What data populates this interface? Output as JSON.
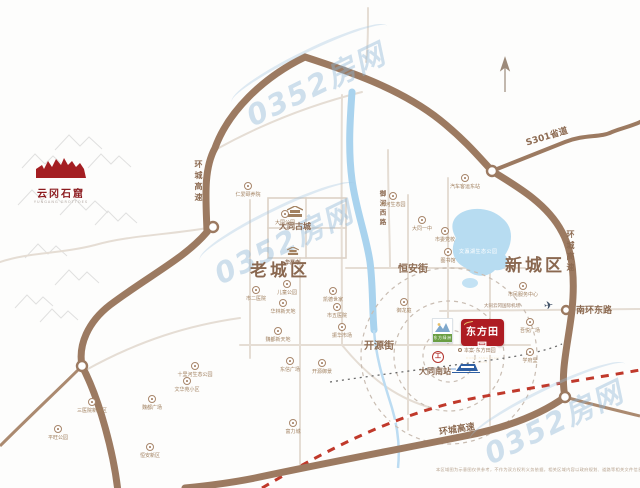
{
  "watermark": {
    "text": "0352房网"
  },
  "logos": {
    "yungang": {
      "title": "云冈石窟",
      "subtitle": "YUNGANG GROTTOES"
    },
    "project": {
      "name": "东方田园",
      "sub": "DONG FANG TIAN YUAN",
      "color": "#ae1c23"
    },
    "sister": {
      "name": "东方绿洲",
      "color": "#6a9e43"
    },
    "site_note": "本案·东方田园"
  },
  "districts": [
    {
      "text": "老城区",
      "x": 250,
      "y": 256
    },
    {
      "text": "新城区",
      "x": 505,
      "y": 251
    }
  ],
  "landmarks": [
    {
      "text": "大同古城"
    },
    {
      "text": "华严寺"
    }
  ],
  "station": {
    "text": "大同南站"
  },
  "lake": {
    "text": "文瀛湖生态公园"
  },
  "airport": {
    "text": "大同云冈国际机场"
  },
  "road_labels": [
    {
      "text": "环城高速",
      "x": 193,
      "y": 160,
      "vertical": true,
      "size": 8
    },
    {
      "text": "环城高速",
      "x": 565,
      "y": 230,
      "vertical": true,
      "size": 8
    },
    {
      "text": "御河西路",
      "x": 377,
      "y": 190,
      "vertical": true,
      "size": 6.5
    },
    {
      "text": "S301省道",
      "x": 524,
      "y": 136,
      "rot": -17,
      "size": 9
    },
    {
      "text": "南环东路",
      "x": 576,
      "y": 303,
      "size": 9
    },
    {
      "text": "恒安街",
      "x": 398,
      "y": 260,
      "size": 10
    },
    {
      "text": "开源街",
      "x": 364,
      "y": 337,
      "size": 10
    },
    {
      "text": "环城高速",
      "x": 438,
      "y": 425,
      "rot": -9,
      "size": 9
    }
  ],
  "markers": [
    {
      "x": 248,
      "y": 186,
      "label": "仁爱颐养院"
    },
    {
      "x": 285,
      "y": 214,
      "label": "大同公园"
    },
    {
      "x": 256,
      "y": 290,
      "label": "市二医院"
    },
    {
      "x": 287,
      "y": 284,
      "label": "儿童公园"
    },
    {
      "x": 283,
      "y": 303,
      "label": "华林新天地"
    },
    {
      "x": 333,
      "y": 291,
      "label": "凯德世家"
    },
    {
      "x": 337,
      "y": 307,
      "label": "市五医院"
    },
    {
      "x": 342,
      "y": 327,
      "label": "振华市场"
    },
    {
      "x": 278,
      "y": 331,
      "label": "魏都新天地"
    },
    {
      "x": 290,
      "y": 361,
      "label": "东信广场"
    },
    {
      "x": 195,
      "y": 366,
      "label": "十里河生态公园"
    },
    {
      "x": 187,
      "y": 381,
      "label": "文华苑小区"
    },
    {
      "x": 152,
      "y": 399,
      "label": "魏都广场"
    },
    {
      "x": 92,
      "y": 402,
      "label": "三医院新院区"
    },
    {
      "x": 58,
      "y": 429,
      "label": "平旺公园"
    },
    {
      "x": 150,
      "y": 447,
      "label": "恒安新区"
    },
    {
      "x": 293,
      "y": 423,
      "label": "富力城"
    },
    {
      "x": 393,
      "y": 196,
      "label": "御河生态园"
    },
    {
      "x": 422,
      "y": 220,
      "label": "大同一中"
    },
    {
      "x": 445,
      "y": 231,
      "label": "市委党校"
    },
    {
      "x": 448,
      "y": 252,
      "label": "图书馆"
    },
    {
      "x": 465,
      "y": 178,
      "label": "汽车客运东站"
    },
    {
      "x": 523,
      "y": 286,
      "label": "市民服务中心"
    },
    {
      "x": 530,
      "y": 322,
      "label": "吾悦广场"
    },
    {
      "x": 530,
      "y": 352,
      "label": "学府里"
    },
    {
      "x": 404,
      "y": 302,
      "label": "御龙庭"
    },
    {
      "x": 322,
      "y": 363,
      "label": "开源御景"
    }
  ],
  "disclaimer": {
    "text": "本区域图为示意图仅供参考，不作为双方权利义务依据，相关区域内容以政府规划、道路等相关文件信息为准。"
  }
}
